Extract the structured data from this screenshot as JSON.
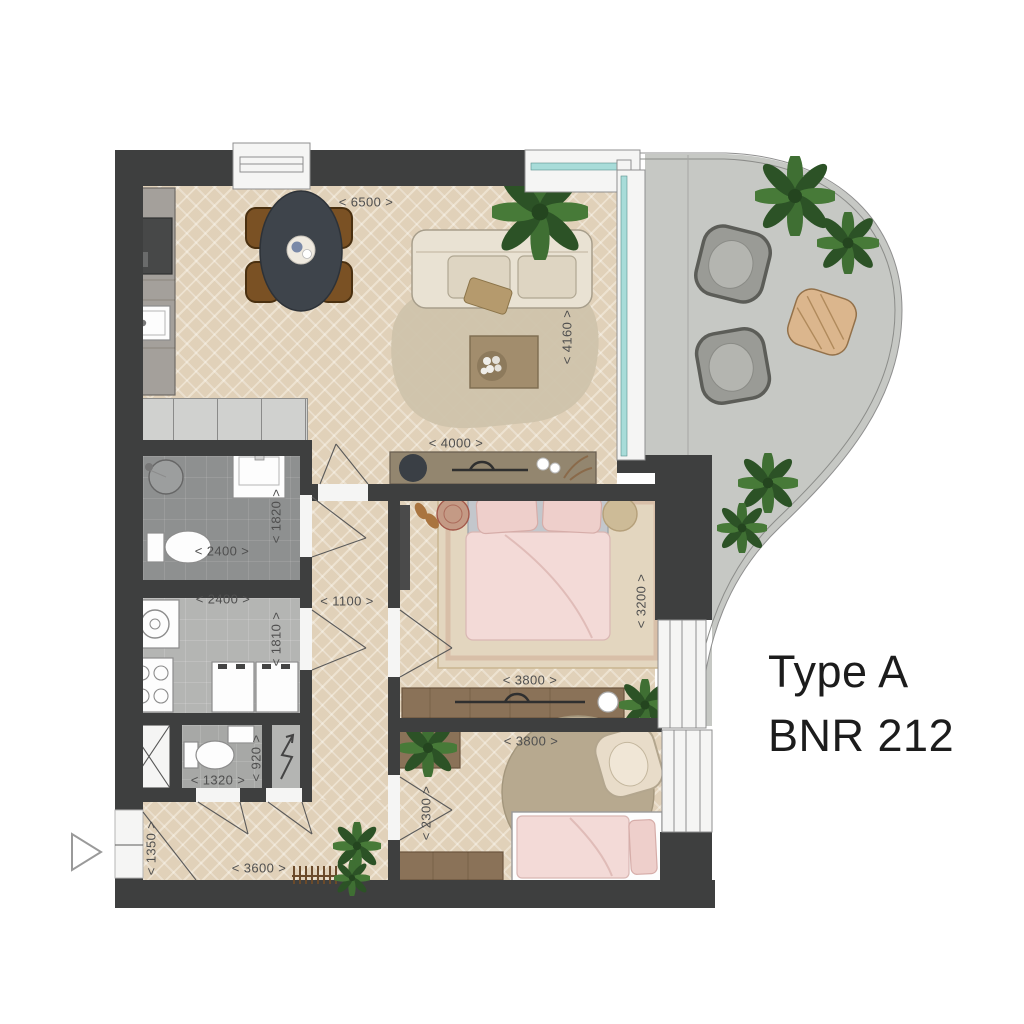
{
  "title": {
    "line1": "Type A",
    "line2": "BNR 212"
  },
  "dimensions": {
    "living_width": "< 6500 >",
    "living_depth": "< 4160 >",
    "sideboard_wall": "< 4000 >",
    "bathroom_depth": "< 1820 >",
    "bathroom_width": "< 2400 >",
    "utility_width": "< 2400 >",
    "utility_depth": "< 1810 >",
    "hall_width": "< 1100 >",
    "bedroom1_depth": "< 3200 >",
    "bedroom1_width": "< 3800 >",
    "bedroom2_width": "< 3800 >",
    "wc_depth": "< 920 >",
    "wc_width": "< 1320 >",
    "bedroom2_depth": "< 2300 >",
    "entry_depth": "< 1350 >",
    "entry_width": "< 3600 >"
  },
  "palette": {
    "wall": "#3e3f3f",
    "wood": "#e8dac3",
    "bath": "#8e9090",
    "util": "#b4b5b3",
    "wc": "#a7a8a6",
    "closet": "#d0d1cf",
    "balcony": "#c6c8c4",
    "glass": "#a8dcd9",
    "windowfill": "#f5f5f4",
    "dimtext": "#4f4f4f",
    "titletext": "#1c1c1c",
    "pink": "#f3dad7",
    "pinkdark": "#eecfcb",
    "plant": "#3f6f33",
    "plantdark": "#2c5226",
    "rug": "#cfc3ab",
    "sofa": "#e9e2d3",
    "deskwood": "#8a7258",
    "sideboard": "#93866f",
    "counter": "#a4a09b",
    "tabledark": "#3e444b",
    "chairbrown": "#7a5124",
    "mattress": "#c3c7cc",
    "rugb1": "#e3d6bf",
    "rugb2": "#b7a98f",
    "lounge": "#e8dcc9"
  }
}
